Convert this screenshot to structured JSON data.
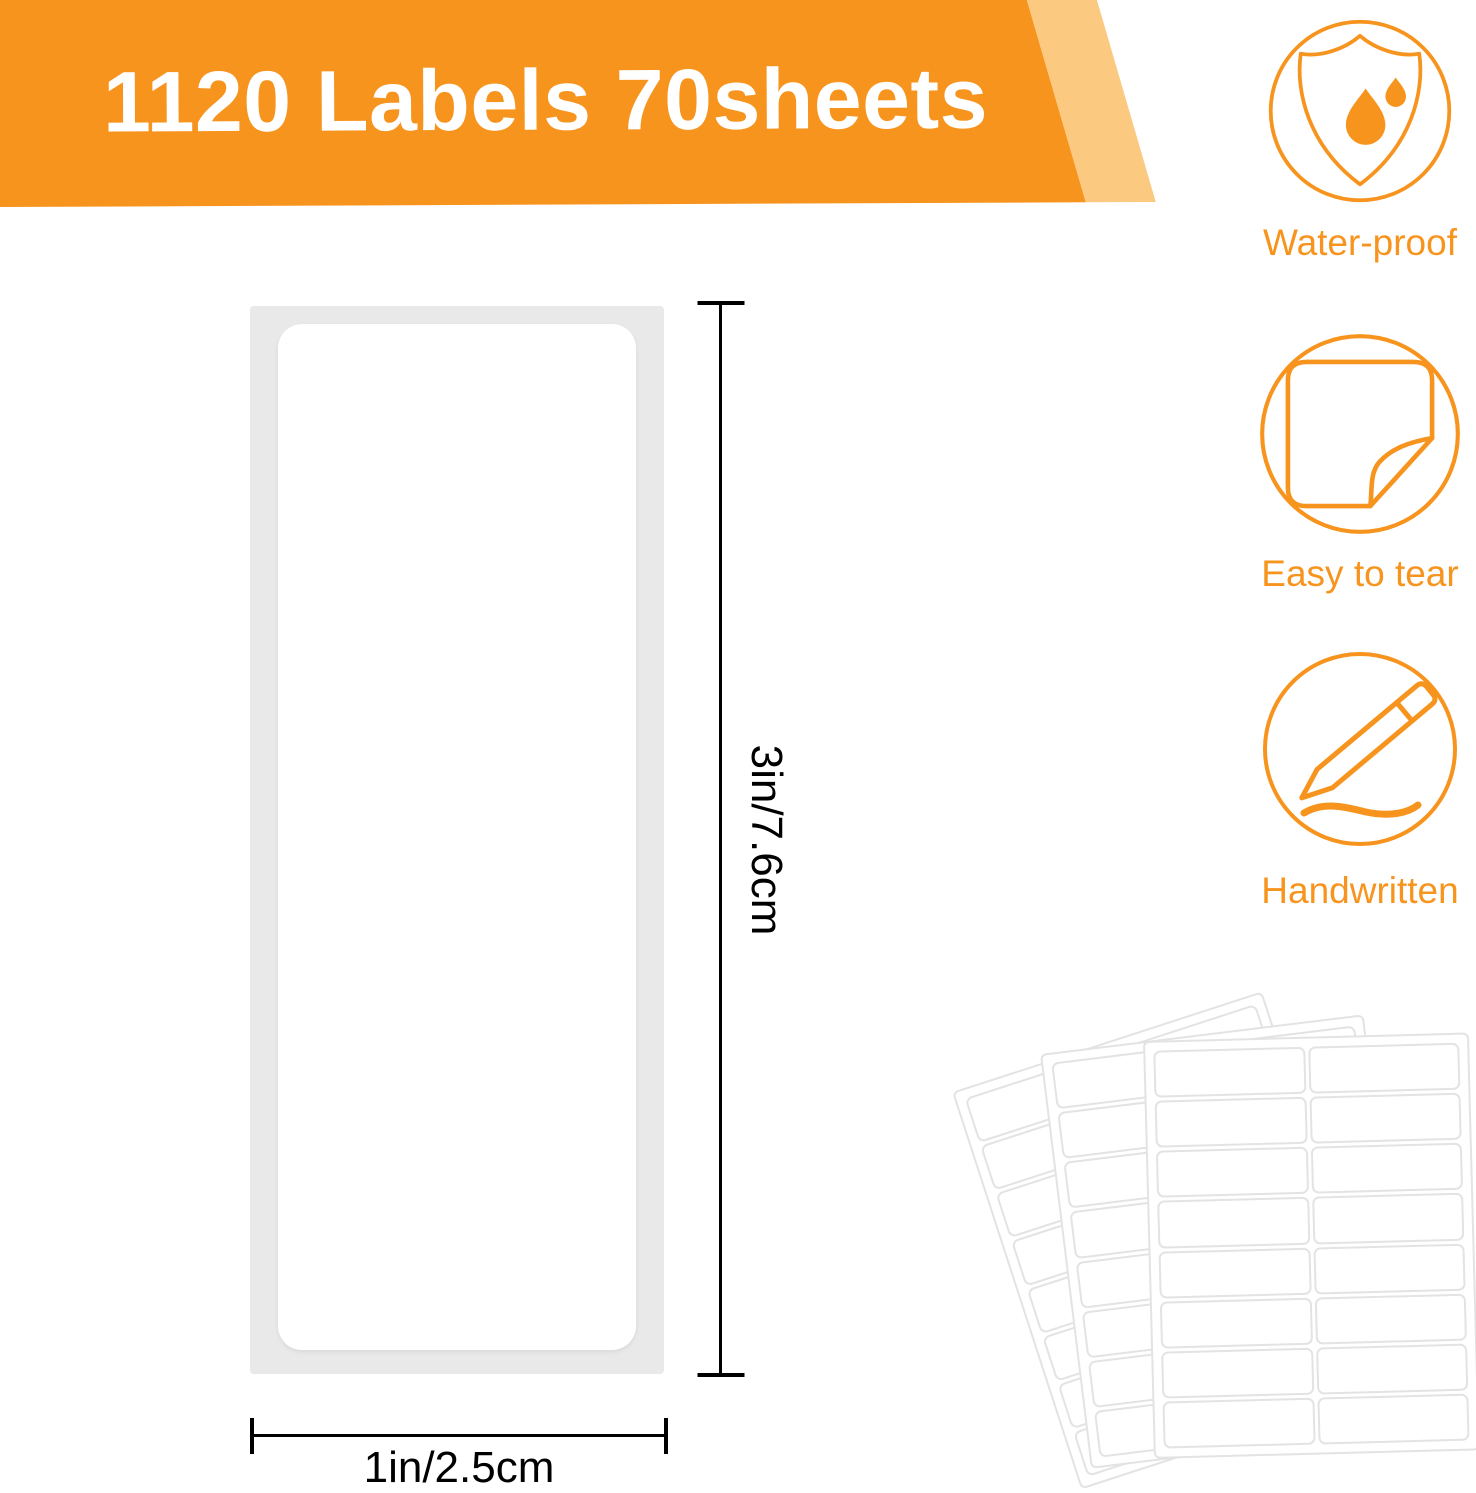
{
  "banner": {
    "title": "1120 Labels 70sheets"
  },
  "features": [
    {
      "label": "Water-proof",
      "icon": "waterproof-shield-icon"
    },
    {
      "label": "Easy to tear",
      "icon": "sticker-peel-icon"
    },
    {
      "label": "Handwritten",
      "icon": "pencil-writing-icon"
    }
  ],
  "label_diagram": {
    "height_dimension": "3in/7.6cm",
    "width_dimension": "1in/2.5cm"
  },
  "sheet_fan": {
    "sheet_count": 3,
    "columns": 2,
    "rows": 8
  },
  "colors": {
    "accent_orange": "#F7941E",
    "banner_band": "#FBC97F",
    "sheet_gray": "#E9E9E9",
    "dimension_line": "#000000",
    "fan_outline": "#E3E3E3"
  }
}
